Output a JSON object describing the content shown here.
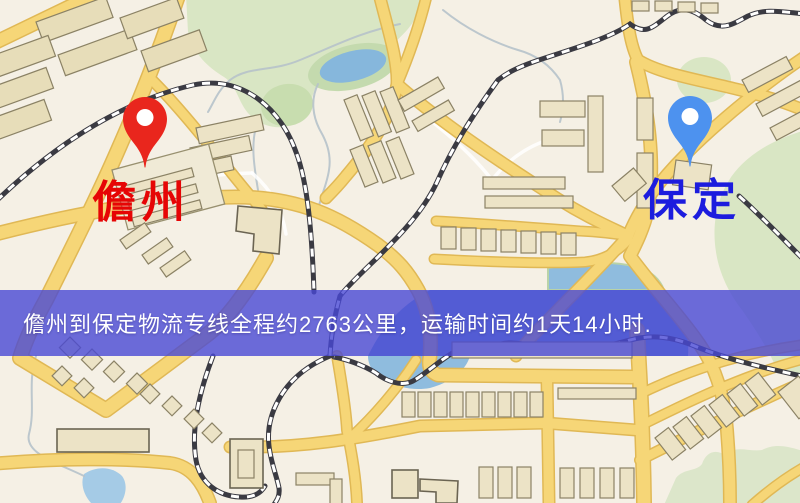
{
  "map": {
    "markers": [
      {
        "label": "儋州",
        "role": "origin",
        "pin_color": "#e9261d",
        "label_color": "#e60505"
      },
      {
        "label": "保定",
        "role": "destination",
        "pin_color": "#4d92ef",
        "label_color": "#1c1cde"
      }
    ],
    "palette": {
      "background": "#f5f0e5",
      "road": "#f6d677",
      "building": "#ece3c6",
      "water": "#8fbcde",
      "park_green": "#d9e6c4",
      "railway": "#3a3a42"
    }
  },
  "banner": {
    "text": "儋州到保定物流专线全程约2763公里，运输时间约1天14小时.",
    "background_color": "#4949d5",
    "text_color": "#ffffff",
    "route": {
      "origin": "儋州",
      "destination": "保定",
      "distance_km": 2763,
      "duration_text": "1天14小时"
    }
  }
}
